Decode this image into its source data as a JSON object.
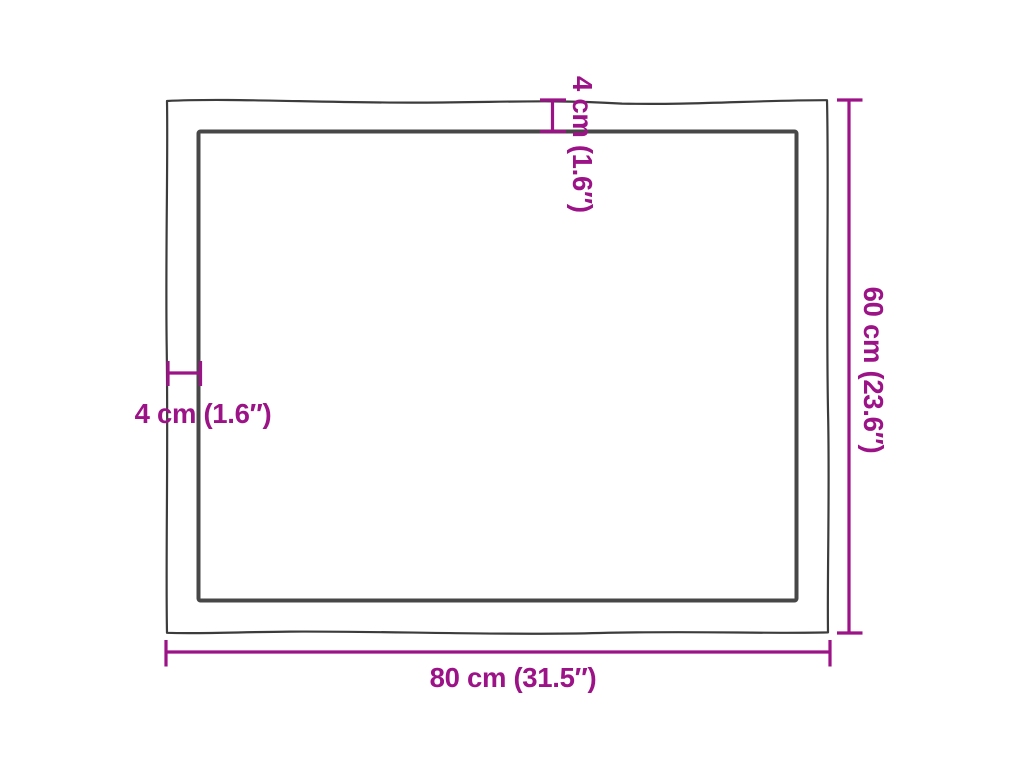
{
  "colors": {
    "accent": "#9C1387",
    "outer_outline": "#3C3C3C",
    "inner_outline": "#474747",
    "background": "#FFFFFF"
  },
  "diagram": {
    "subject": "table-top-with-live-edge-top-view",
    "width_label": "80 cm (31.5″)",
    "height_label": "60 cm (23.6″)",
    "edge_thickness_top_label": "4 cm (1.6″)",
    "edge_thickness_left_label": "4 cm (1.6″)",
    "width_cm": 80,
    "width_in": 31.5,
    "height_cm": 60,
    "height_in": 23.6,
    "edge_cm": 4,
    "edge_in": 1.6
  }
}
